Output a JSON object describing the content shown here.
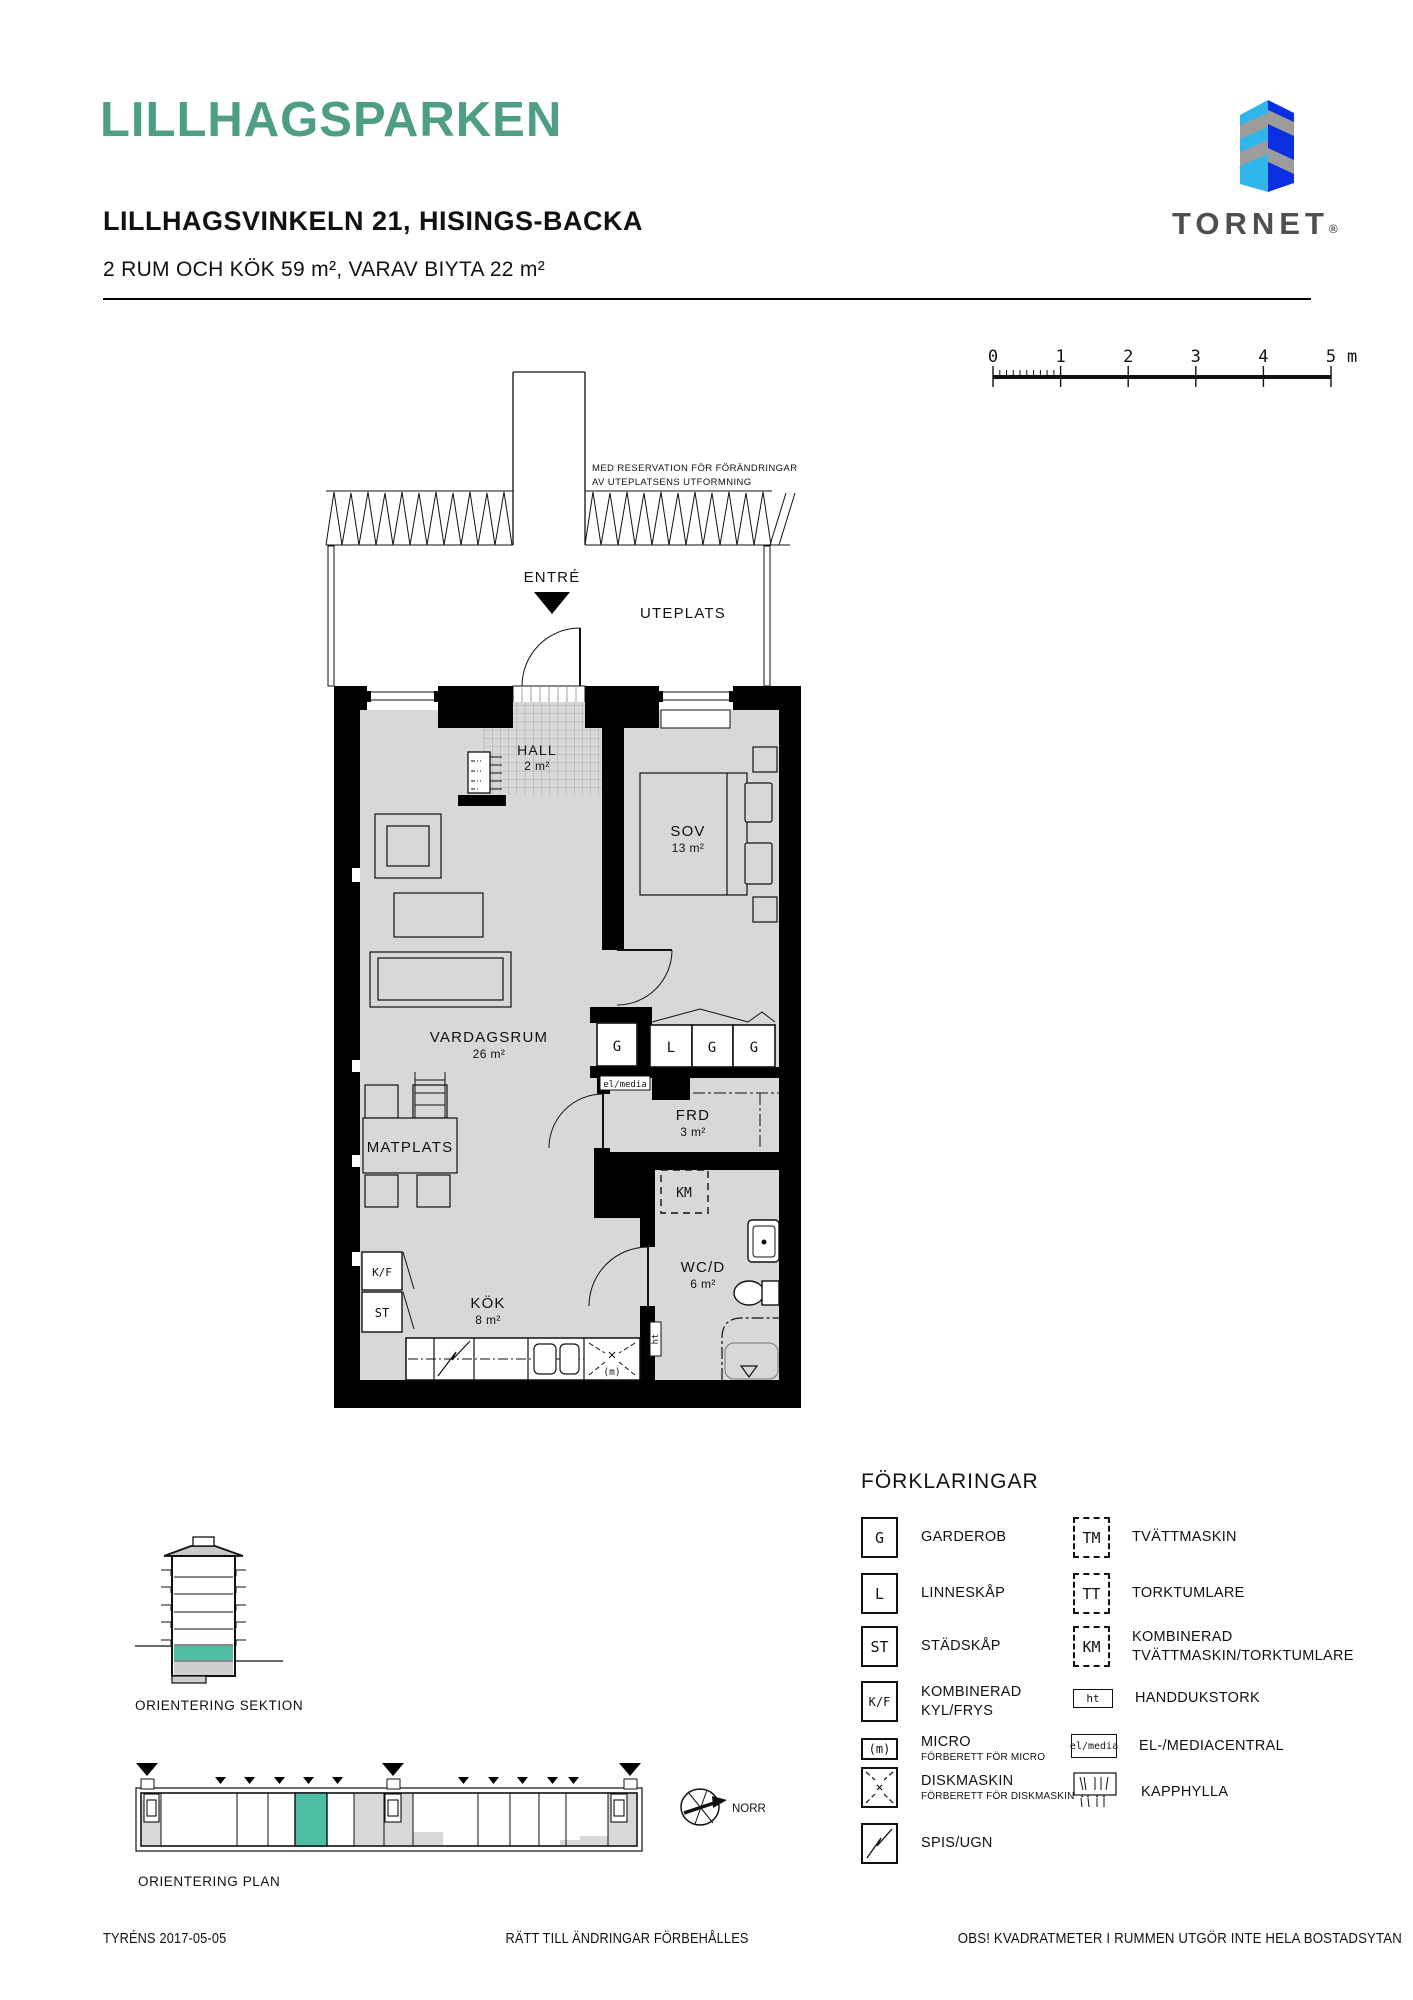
{
  "header": {
    "title": "LILLHAGSPARKEN",
    "address": "LILLHAGSVINKELN 21, HISINGS-BACKA",
    "subtitle": "2 RUM OCH KÖK 59 m², VARAV BIYTA 22 m²"
  },
  "logo": {
    "brand": "TORNET",
    "registered": "®"
  },
  "scalebar": {
    "labels": [
      "0",
      "1",
      "2",
      "3",
      "4",
      "5"
    ],
    "unit": "m"
  },
  "plan": {
    "note_line1": "MED RESERVATION FÖR FÖRÄNDRINGAR",
    "note_line2": "AV UTEPLATSENS UTFORMNING",
    "entre_label": "ENTRÉ",
    "uteplats_label": "UTEPLATS",
    "hall": {
      "name": "HALL",
      "area": "2 m²"
    },
    "sov": {
      "name": "SOV",
      "area": "13 m²"
    },
    "vardagsrum": {
      "name": "VARDAGSRUM",
      "area": "26 m²"
    },
    "matplats": {
      "name": "MATPLATS"
    },
    "frd": {
      "name": "FRD",
      "area": "3 m²"
    },
    "kok": {
      "name": "KÖK",
      "area": "8 m²"
    },
    "wcd": {
      "name": "WC/D",
      "area": "6 m²"
    },
    "sym_g1": "G",
    "sym_l": "L",
    "sym_g2": "G",
    "sym_g3": "G",
    "sym_elmedia": "el/media",
    "sym_km": "KM",
    "sym_kf": "K/F",
    "sym_st": "ST",
    "sym_ht": "ht",
    "sym_micro": "(m)"
  },
  "legend": {
    "heading": "FÖRKLARINGAR",
    "items_left": [
      {
        "symbol": "G",
        "label": "GARDEROB"
      },
      {
        "symbol": "L",
        "label": "LINNESKÅP"
      },
      {
        "symbol": "ST",
        "label": "STÄDSKÅP"
      },
      {
        "symbol": "K/F",
        "label": "KOMBINERAD",
        "label2": "KYL/FRYS"
      },
      {
        "symbol": "(m)",
        "label": "MICRO",
        "sublabel": "FÖRBERETT FÖR MICRO"
      },
      {
        "symbol": "",
        "label": "DISKMASKIN",
        "sublabel": "FÖRBERETT FÖR DISKMASKIN"
      },
      {
        "symbol": "",
        "label": "SPIS/UGN"
      }
    ],
    "items_right": [
      {
        "symbol": "TM",
        "label": "TVÄTTMASKIN"
      },
      {
        "symbol": "TT",
        "label": "TORKTUMLARE"
      },
      {
        "symbol": "KM",
        "label": "KOMBINERAD",
        "label2": "TVÄTTMASKIN/TORKTUMLARE"
      },
      {
        "symbol": "ht",
        "label": "HANDDUKSTORK"
      },
      {
        "symbol": "el/media",
        "label": "EL-/MEDIACENTRAL"
      },
      {
        "symbol": "",
        "label": "KAPPHYLLA"
      }
    ]
  },
  "orientation": {
    "section_label": "ORIENTERING SEKTION",
    "plan_label": "ORIENTERING PLAN",
    "north_label": "NORR"
  },
  "footer": {
    "left": "TYRÉNS 2017-05-05",
    "center": "RÄTT TILL ÄNDRINGAR FÖRBEHÅLLES",
    "right": "OBS! KVADRATMETER I RUMMEN UTGÖR INTE HELA BOSTADSYTAN"
  },
  "colors": {
    "accent": "#4E9E86",
    "highlight": "#4FBFA3",
    "floor_gray": "#D8D8D8",
    "logo_light_blue": "#2FB7EC",
    "logo_dark_blue": "#0A2FE0",
    "logo_gray": "#9C9C9C",
    "logo_text": "#4F4F4F"
  }
}
